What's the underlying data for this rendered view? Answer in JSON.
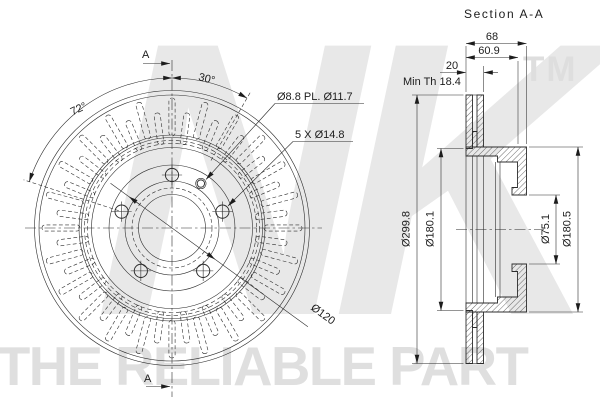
{
  "section_title": "Section A-A",
  "watermark": {
    "logo": "NK",
    "tm": "TM",
    "tagline": "THE RELIABLE PART"
  },
  "front_view": {
    "angle_slot_pitch": "30°",
    "angle_bolt_spacing": "72°",
    "pilot_hole_note": "Ø8.8 PL. Ø11.7",
    "bolt_hole_note": "5 X Ø14.8",
    "bolt_circle_dia": "Ø120",
    "section_marker_top": "A",
    "section_marker_bottom": "A"
  },
  "section_view": {
    "overall_width": "68",
    "hat_depth": "60.9",
    "disc_thickness": "20",
    "min_thickness_note": "Min Th 18.4",
    "outer_dia": "Ø299.8",
    "band_inner_dia": "Ø180.1",
    "center_bore_dia": "Ø75.1",
    "hat_outer_dia": "Ø180.5"
  },
  "geometry": {
    "front": {
      "cx": 172,
      "cy": 228,
      "circles_solid": [
        137.5,
        133,
        93,
        90.5,
        80.5,
        63,
        47,
        33.5
      ],
      "circles_dash_dense": [
        87.5,
        84.5
      ],
      "circles_dashed": [
        40
      ],
      "bolt": {
        "count": 5,
        "R": 53,
        "r": 6.6,
        "start_deg": 270
      },
      "pilot": {
        "deg": 303,
        "R": 53,
        "r_outer": 5.2,
        "r_inner": 3.7
      },
      "slots": {
        "outer": {
          "count": 24,
          "start": 0,
          "r1": 92,
          "r2": 130,
          "w": 6.2
        },
        "inner": {
          "count": 24,
          "start": 7.5,
          "r1": 84,
          "r2": 116,
          "w": 6.2
        }
      }
    }
  }
}
